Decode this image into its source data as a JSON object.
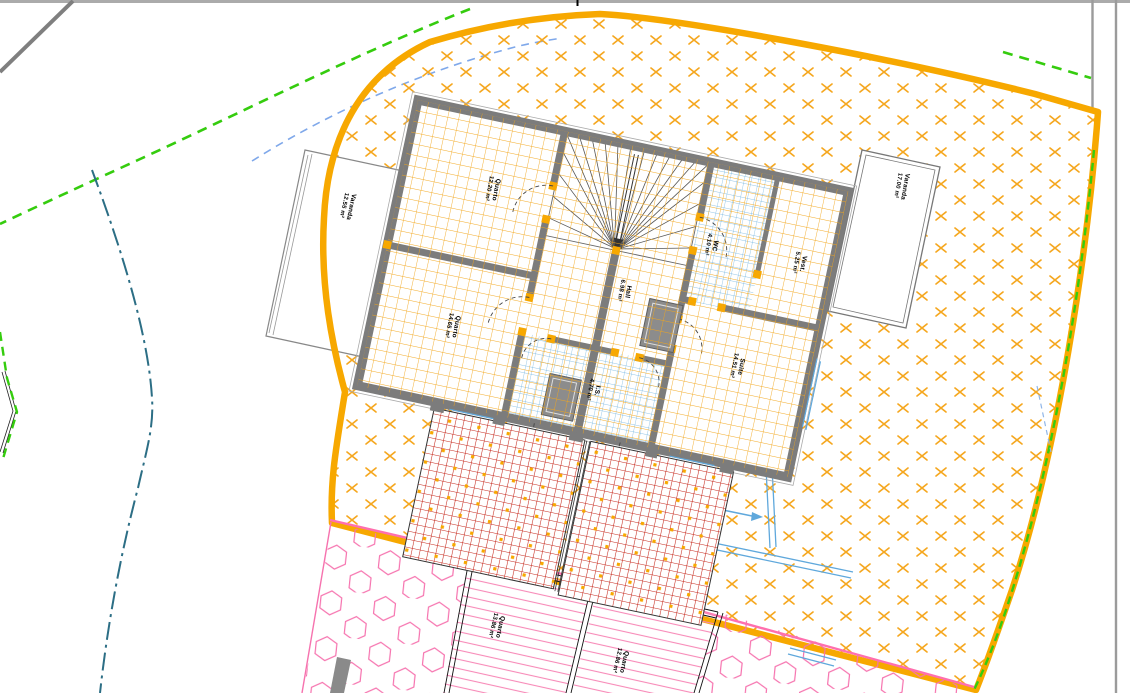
{
  "drawing": {
    "kind": "architectural-site-and-floor-plan"
  },
  "rooms": [
    {
      "name": "Varanda",
      "area": "12.55 m²"
    },
    {
      "name": "Quarto",
      "area": "12.20 m²"
    },
    {
      "name": "Quarto",
      "area": "14.65 m²"
    },
    {
      "name": "Hall",
      "area": "6.98 m²"
    },
    {
      "name": "I.S.",
      "area": "4.70 m²"
    },
    {
      "name": "WC",
      "area": "4.10 m²"
    },
    {
      "name": "Vest.",
      "area": "5.25 m²"
    },
    {
      "name": "Suite",
      "area": "14.51 m²"
    },
    {
      "name": "Varanda",
      "area": "17.00 m²"
    },
    {
      "name": "Quarto",
      "area": "13.86 m²"
    },
    {
      "name": "Quarto",
      "area": "12.86 m²"
    }
  ],
  "colors": {
    "plot_boundary_orange": "#F7A800",
    "cross_hatch_orange": "#F5A71F",
    "tile_grid_orange": "#F2A61B",
    "wall_gray": "#7C7C7C",
    "brick_red": "#C5281C",
    "pink_boundary": "#FF6FAE",
    "pink_hatch": "#F672AE",
    "green_dashed": "#35CC0E",
    "blue_dashed": "#7FA8EA",
    "teal_dashdot": "#2C6E85",
    "tile_blue": "#6FB2DF",
    "border_gray": "#9B9B9B"
  }
}
